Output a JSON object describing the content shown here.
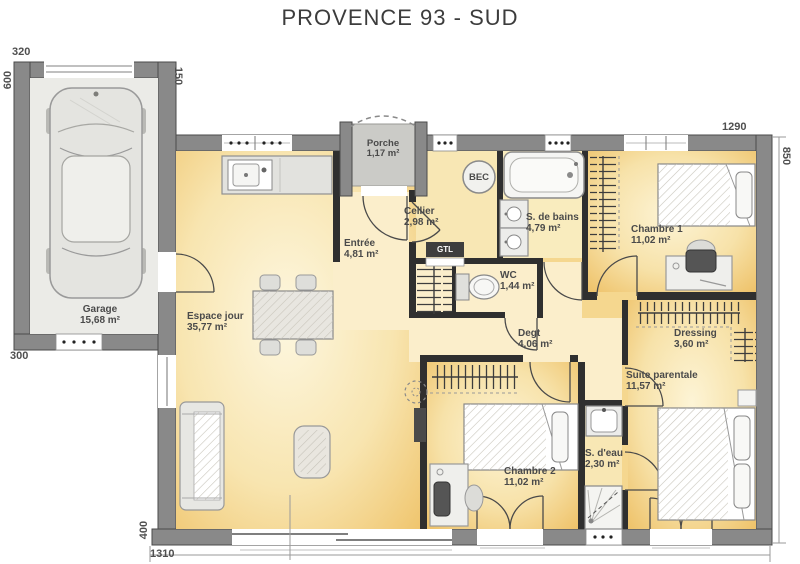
{
  "title": "PROVENCE 93 - SUD",
  "rooms": {
    "garage": {
      "name": "Garage",
      "area": "15,68 m²"
    },
    "porche": {
      "name": "Porche",
      "area": "1,17 m²"
    },
    "espace_jour": {
      "name": "Espace jour",
      "area": "35,77 m²"
    },
    "entree": {
      "name": "Entrée",
      "area": "4,81 m²"
    },
    "cellier": {
      "name": "Cellier",
      "area": "2,98 m²"
    },
    "sdb": {
      "name": "S. de bains",
      "area": "4,79 m²"
    },
    "wc": {
      "name": "WC",
      "area": "1,44 m²"
    },
    "chambre1": {
      "name": "Chambre 1",
      "area": "11,02 m²"
    },
    "degt": {
      "name": "Degt",
      "area": "4,06 m²"
    },
    "dressing": {
      "name": "Dressing",
      "area": "3,60 m²"
    },
    "suite": {
      "name": "Suite parentale",
      "area": "11,57 m²"
    },
    "chambre2": {
      "name": "Chambre 2",
      "area": "11,02 m²"
    },
    "sdeau": {
      "name": "S. d'eau",
      "area": "2,30 m²"
    }
  },
  "equipment": {
    "water_heater": "BEC",
    "technical_box": "GTL"
  },
  "dimensions": {
    "garage_width": "320",
    "garage_depth": "600",
    "garage_rear": "300",
    "garage_link": "150",
    "house_width": "1290",
    "house_depth": "850",
    "left_lower": "400",
    "total_width": "1310"
  },
  "colors": {
    "wall_gray": "#898989",
    "interior_wall": "#2f2f2f",
    "room_yellow": "#efc369",
    "room_pale": "#fbeecb",
    "porch_gray": "#cbcbc7"
  }
}
